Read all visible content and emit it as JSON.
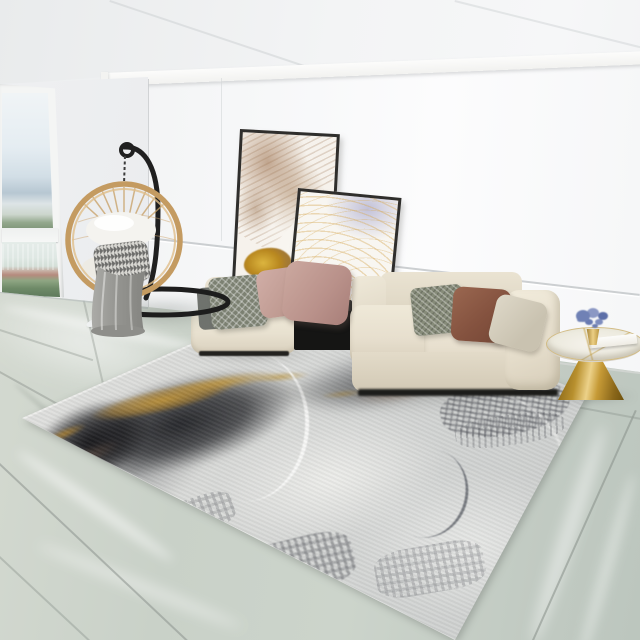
{
  "image": {
    "type": "interior-product-photo",
    "subject": "Abstract gray, white and gold area rug styled in a bright modern living room",
    "width": 640,
    "height": 640,
    "visible_text": "none"
  },
  "palette": {
    "ceiling": "#eef0f1",
    "wallBack": "#f7f8f9",
    "wallLeft": "#e7e9eb",
    "beamWhite": "#fbfbfa",
    "floorA": "#d4d9d0",
    "floorB": "#c3ccc3",
    "grout": "#93a096",
    "rugBase": "#dcdddb",
    "rugDark": "#26272b",
    "rugGold": "#bf9338",
    "rugGray": "#8e9095",
    "rugWhite": "#f0f0ee",
    "sofaCream": "#eae3d3",
    "sofaShade": "#d7cfbc",
    "consoleBlack": "#171716",
    "pillowGreen": "#82876f",
    "pillowBrown": "#8c5a45",
    "pillowBeige": "#d8d2c2",
    "pillowPink": "#c7a59e",
    "pillowMauve": "#b48e87",
    "pillowCheck": "#7c8172",
    "rattan": "#c49b61",
    "standBlack": "#202020",
    "cushionWhite": "#f3f2ee",
    "blanketGray": "#9b9b97",
    "tableGold": "#c0912f",
    "marbleTop": "#f3f0ea",
    "flowerBlue": "#6678b0",
    "paintingTan": "#a97f58",
    "paintingGold": "#c79a2c",
    "paintingLavender": "#b4b4d4",
    "frameDark": "#2f2e2c",
    "windowSky": "#e9f0f4",
    "windowHills": "#b5c5d0",
    "treeGreen": "#6f8a68",
    "buildingRed": "#b3836f"
  },
  "objects": {
    "window": {
      "label": "tall window with city view",
      "panes": [
        "sky and distant skyline",
        "white high-rises, red roofs and trees"
      ]
    },
    "hanging_chair": {
      "label": "rattan hanging egg chair on black stand",
      "accessories": [
        "white cushion",
        "houndstooth pillow",
        "gray throw blanket"
      ]
    },
    "wall_art": {
      "label": "two leaning framed abstract paintings",
      "painting_left": "tan marble veins with gold-leaf splash",
      "painting_right": "gold contour lines with lavender wash"
    },
    "sofa": {
      "label": "cream modular low sofa with black console insert and magazines",
      "pillows": [
        "gray check",
        "dusty pink",
        "mauve",
        "sage pattern",
        "rust brown",
        "beige"
      ]
    },
    "side_table": {
      "label": "gold cone pedestal side table with marble top",
      "decor": [
        "blue hydrangea in gold vase",
        "white book"
      ]
    },
    "rug": {
      "label": "abstract art area rug",
      "design": "charcoal brush mass, gold streaks, white sweeping arc, gray glitch patches on light gray"
    },
    "floor": {
      "label": "polished green-gray marble tile floor"
    },
    "slippers": {
      "label": "pair of white slippers"
    }
  }
}
